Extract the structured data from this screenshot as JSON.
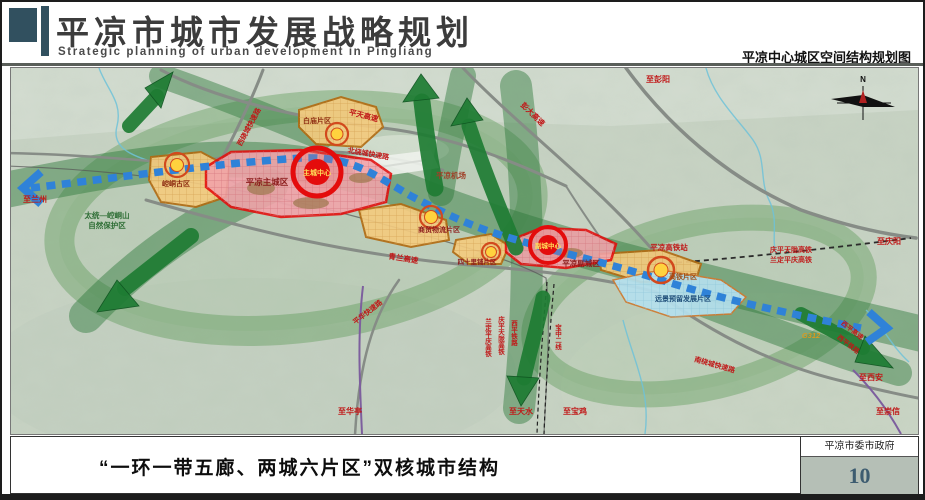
{
  "header": {
    "title": "平凉市城市发展战略规划",
    "subtitle_en": "Strategic planning of urban development in Pingliang",
    "right_caption": "平凉中心城区空间结构规划图"
  },
  "footer": {
    "caption": "“一环一带五廊、两城六片区”双核城市结构",
    "agency": "平凉市委市政府",
    "page_number": "10"
  },
  "map": {
    "compass": "N",
    "zones": {
      "main_city": "平凉主城区",
      "main_center": "主城中心",
      "sub_city": "平凉副城区",
      "sub_center": "副城中心",
      "baimiao": "白庙片区",
      "kongtong": "崆峒古区",
      "trade": "商贸物流片区",
      "sishilipu": "四十里铺片区",
      "hsr_zone": "高铁片区",
      "reserved": "远景预留发展片区",
      "airport": "平凉机场",
      "nature_reserve_1": "太统—崆峒山",
      "nature_reserve_2": "自然保护区"
    },
    "roads": {
      "pingtian": "平天高速",
      "pengda": "彭大高速",
      "north_ring": "北绕城快速路",
      "west_ring": "西绕城快速路",
      "south_ring": "南绕城快速路",
      "qinglan": "青兰高速",
      "pinghua": "平华快速路",
      "g312": "G312",
      "xiping_hwy": "西平高速",
      "xiping_rail": "西平铁路"
    },
    "railways": {
      "hsr_station": "平凉高铁站",
      "hsr_1": "庆平天陇高铁",
      "hsr_2": "兰定平庆高铁",
      "xiping_v": "西平铁路",
      "qingping_v": "庆平天陇高铁",
      "landing_v": "兰定平庆高铁",
      "baozhong_v": "宝中二线"
    },
    "directions": {
      "lanzhou": "至兰州",
      "pengyang": "至彭阳",
      "qingyang": "至庆阳",
      "xian": "至西安",
      "chongxin": "至崇信",
      "huating": "至华亭",
      "tianshui": "至天水",
      "baoji": "至宝鸡"
    }
  },
  "colors": {
    "header_slate": "#31505f",
    "accent_red": "#e40c0c",
    "zone_orange": "#f3c87e",
    "axis_blue": "#2f82d8",
    "corridor_green": "#2e7d3c",
    "reserved_blue": "#b5e0ee"
  }
}
